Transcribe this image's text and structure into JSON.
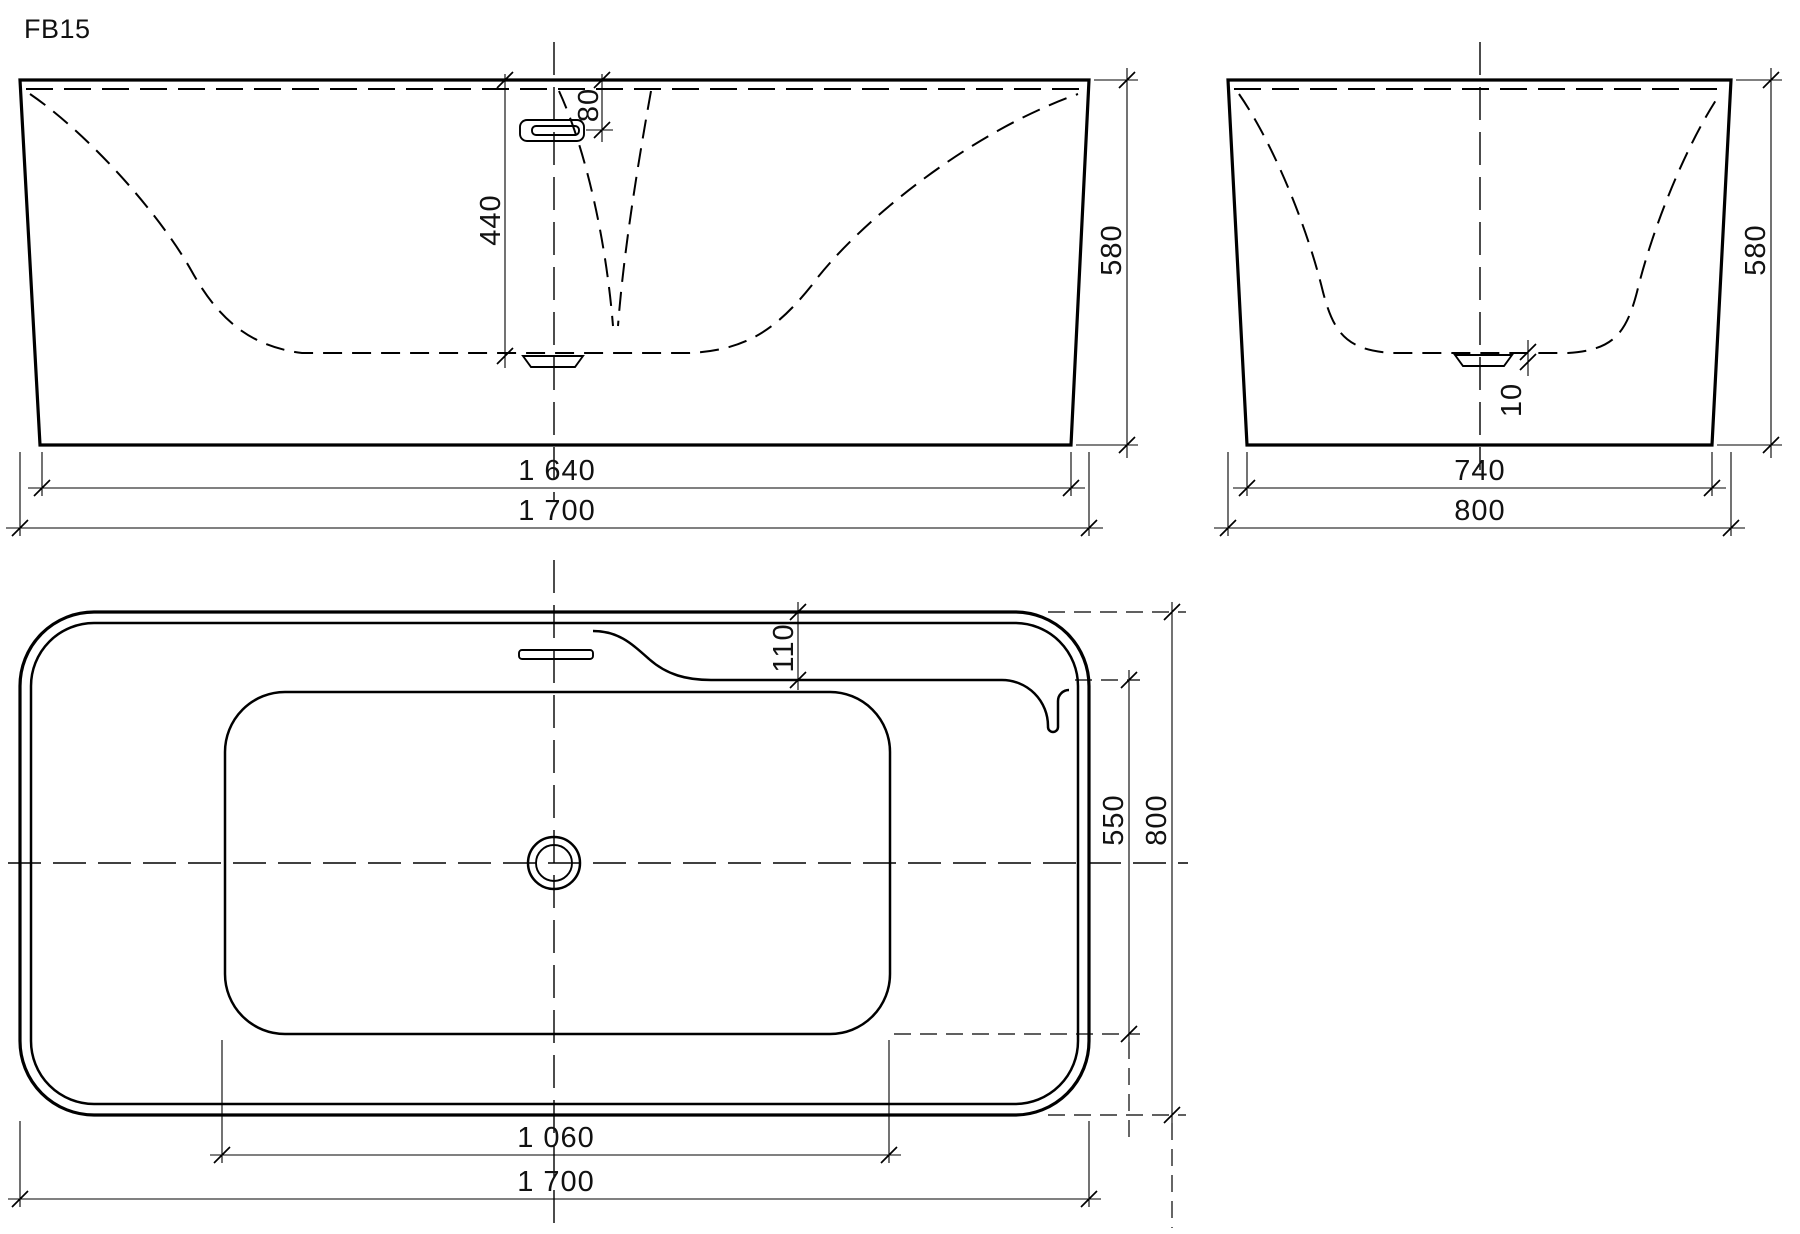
{
  "title": "FB15",
  "colors": {
    "line": "#000000",
    "background": "#ffffff"
  },
  "views": {
    "front_elevation": {
      "dims": {
        "overall_length": "1 700",
        "base_length": "1 640",
        "height": "580",
        "depth_to_drain": "440",
        "overflow_drop": "80"
      }
    },
    "end_elevation": {
      "dims": {
        "overall_width": "800",
        "base_width": "740",
        "height": "580",
        "drain_recess": "10"
      }
    },
    "plan": {
      "dims": {
        "overall_length": "1 700",
        "floor_length": "1 060",
        "overall_width": "800",
        "floor_width": "550",
        "deck_depth": "110"
      }
    }
  }
}
